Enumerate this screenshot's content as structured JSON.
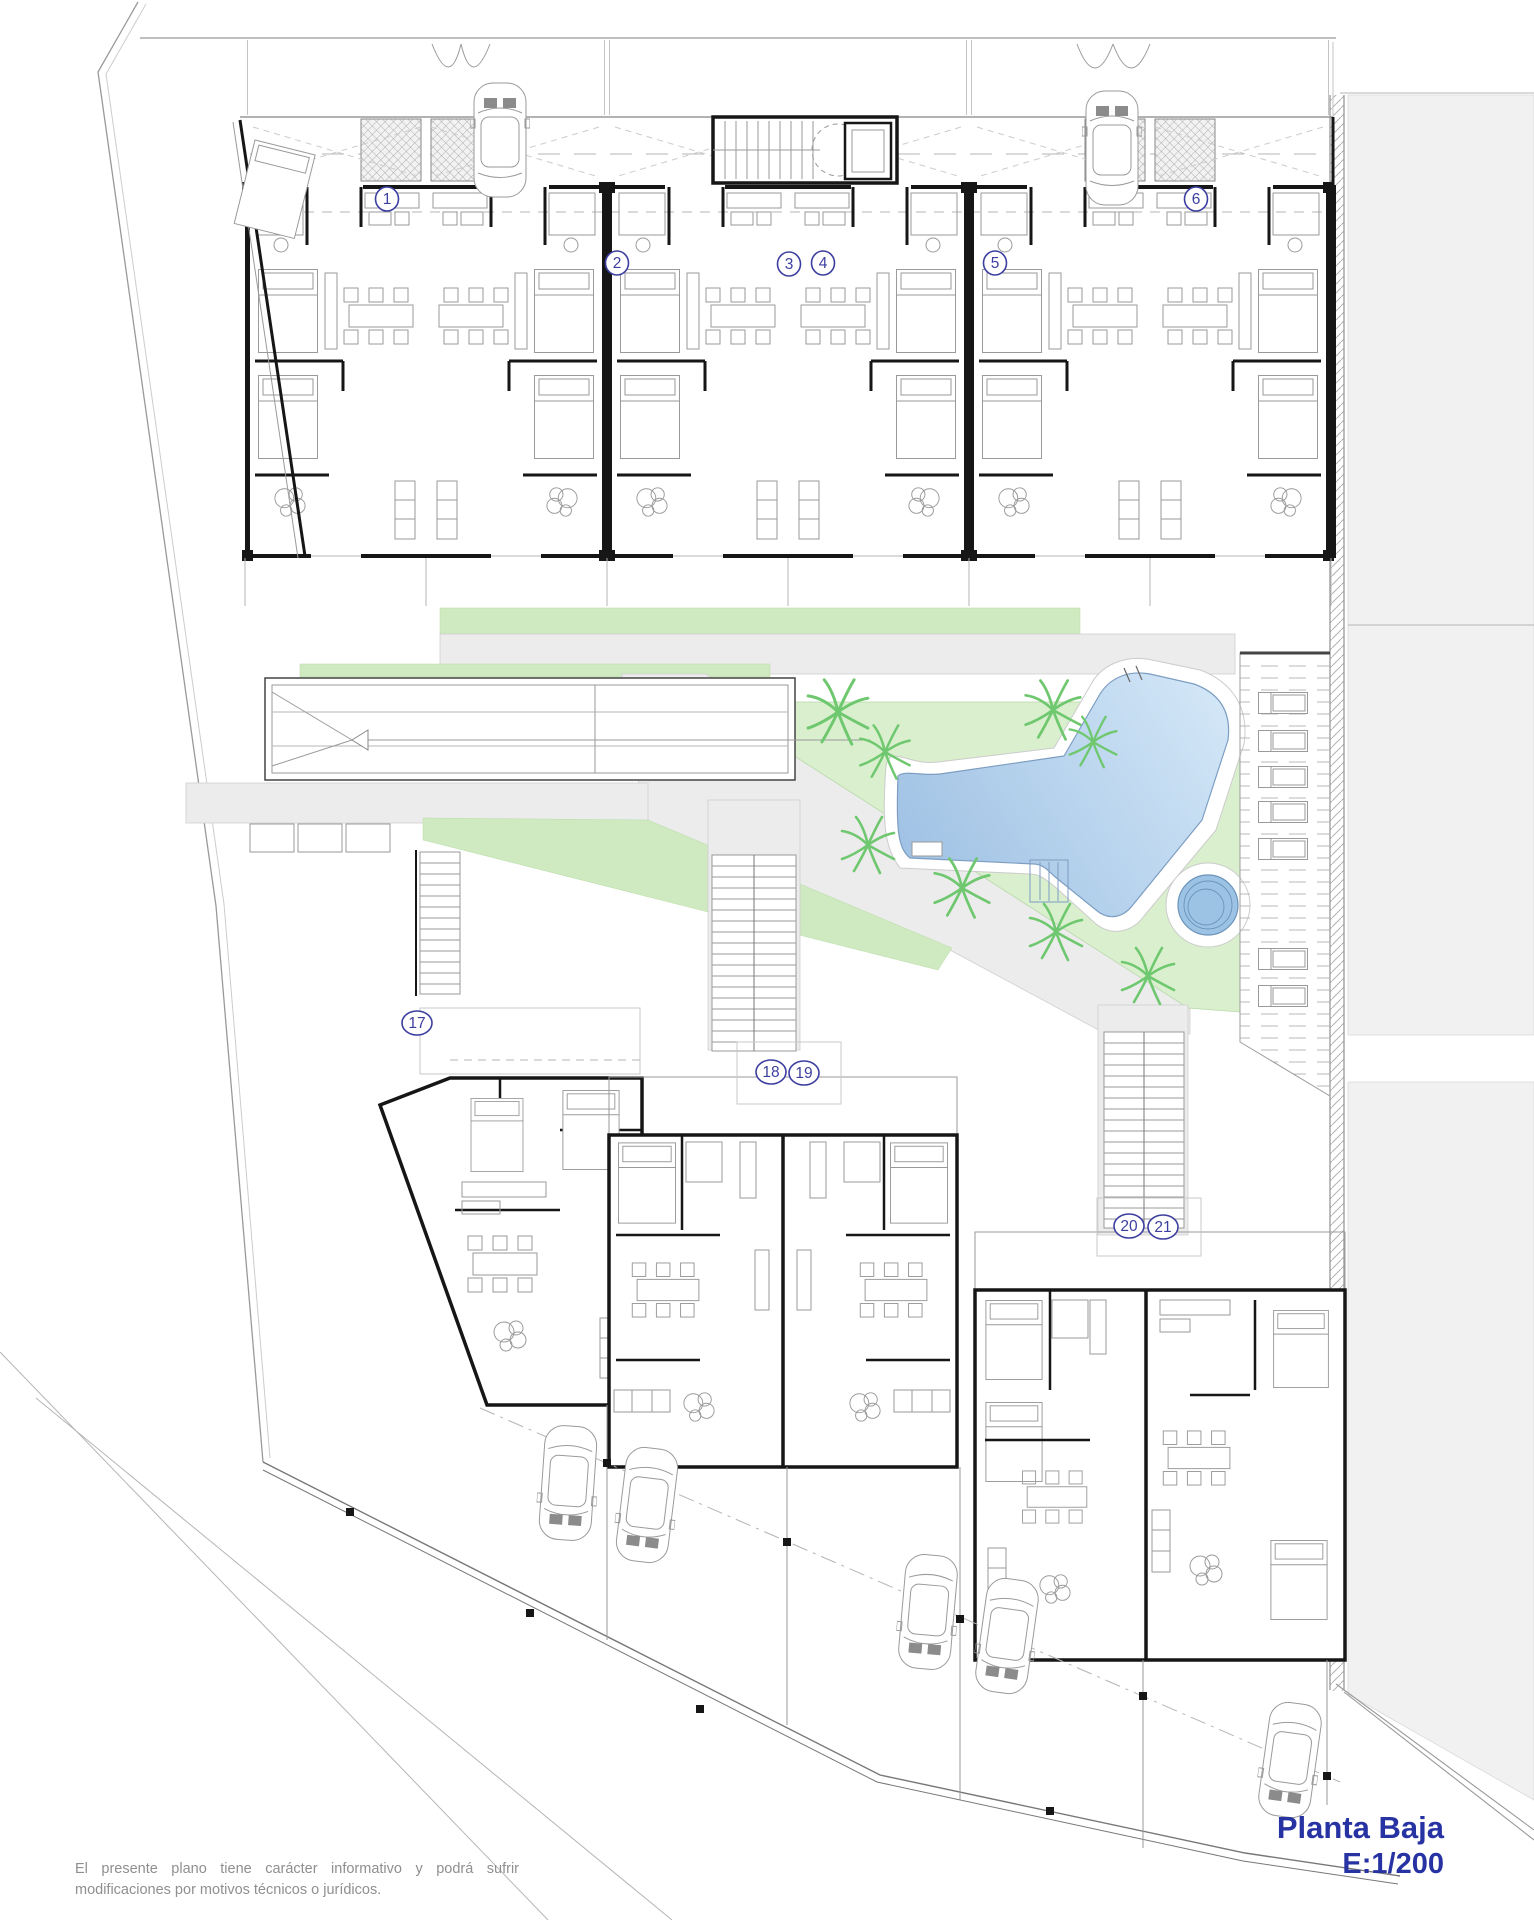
{
  "drawing": {
    "title": "Planta Baja",
    "scale": "E:1/200",
    "disclaimer_line1": "El presente plano tiene carácter informativo y podrá sufrir",
    "disclaimer_line2": "modificaciones por motivos técnicos o jurídicos.",
    "unit_labels": [
      {
        "n": "1",
        "x": 387,
        "y": 199
      },
      {
        "n": "2",
        "x": 617,
        "y": 263
      },
      {
        "n": "3",
        "x": 789,
        "y": 264
      },
      {
        "n": "4",
        "x": 823,
        "y": 263
      },
      {
        "n": "5",
        "x": 995,
        "y": 263
      },
      {
        "n": "6",
        "x": 1196,
        "y": 199
      },
      {
        "n": "17",
        "x": 417,
        "y": 1023
      },
      {
        "n": "18",
        "x": 771,
        "y": 1072
      },
      {
        "n": "19",
        "x": 804,
        "y": 1073
      },
      {
        "n": "20",
        "x": 1129,
        "y": 1226
      },
      {
        "n": "21",
        "x": 1163,
        "y": 1227
      }
    ],
    "palms": [
      {
        "x": 838,
        "y": 712,
        "s": 1.15
      },
      {
        "x": 885,
        "y": 752,
        "s": 0.95
      },
      {
        "x": 1053,
        "y": 710,
        "s": 1.05
      },
      {
        "x": 1093,
        "y": 742,
        "s": 0.9
      },
      {
        "x": 868,
        "y": 845,
        "s": 1.0
      },
      {
        "x": 962,
        "y": 888,
        "s": 1.05
      },
      {
        "x": 1056,
        "y": 932,
        "s": 1.0
      },
      {
        "x": 1148,
        "y": 976,
        "s": 1.0
      }
    ],
    "cars": [
      {
        "x": 500,
        "y": 140,
        "r": 0
      },
      {
        "x": 1112,
        "y": 148,
        "r": 0
      },
      {
        "x": 568,
        "y": 1483,
        "r": 184
      },
      {
        "x": 647,
        "y": 1505,
        "r": 187
      },
      {
        "x": 928,
        "y": 1612,
        "r": 185
      },
      {
        "x": 1007,
        "y": 1636,
        "r": 188
      },
      {
        "x": 1290,
        "y": 1760,
        "r": 188
      }
    ],
    "loungers": [
      {
        "x": 1258,
        "y": 692
      },
      {
        "x": 1258,
        "y": 730
      },
      {
        "x": 1258,
        "y": 766
      },
      {
        "x": 1258,
        "y": 801
      },
      {
        "x": 1258,
        "y": 838
      },
      {
        "x": 1258,
        "y": 948
      },
      {
        "x": 1258,
        "y": 985
      }
    ],
    "colors": {
      "title_blue": "#2733a3",
      "label_blue": "#3c3f9f",
      "pool_light": "#d6e9f8",
      "pool_dark": "#9cbfe3",
      "spa_blue": "#9cc3e4",
      "lawn_green": "#d9efcd",
      "strip_green": "#cfe9c0",
      "path_gray": "#ececec",
      "street_gray": "#f1f1f1"
    }
  }
}
